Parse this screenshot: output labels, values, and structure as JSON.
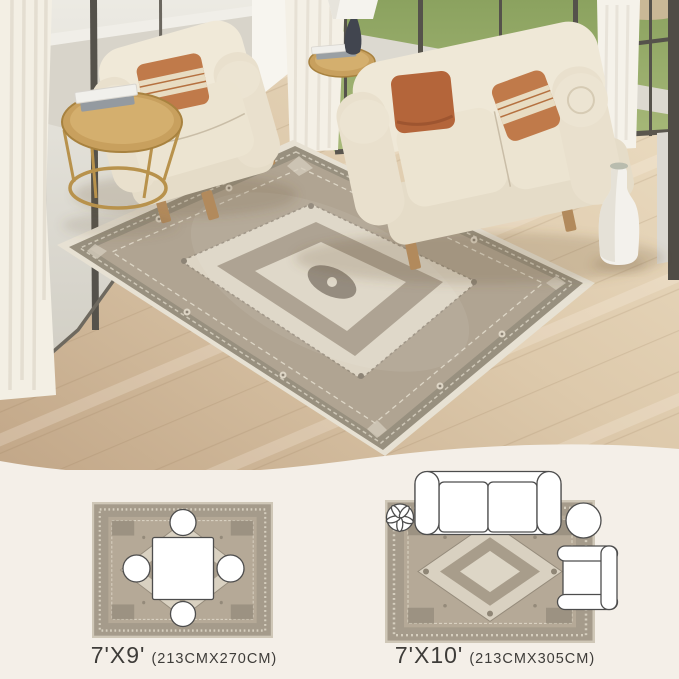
{
  "page": {
    "kind": "rug-product-image",
    "background": "#f4efe8",
    "text_color": "#3e3c39"
  },
  "scene": {
    "name": "living-room-with-medallion-rug",
    "elements": [
      "area-rug",
      "loveseat-sofa",
      "armchair",
      "rust-pillows",
      "gold-side-tables",
      "table-lamp",
      "white-vase",
      "floor-to-ceiling-windows",
      "sheer-curtains",
      "wood-floor"
    ],
    "palette": {
      "rug_field": "#b0a492",
      "rug_border": "#98907f",
      "rug_cream": "#e7e1d3",
      "sofa_cream": "#ece4d2",
      "pillow_rust_solid": "#b4653a",
      "pillow_rust_striped": "#c07a4a",
      "floor_wood": "#d9c3a3",
      "grass_green": "#96ab66",
      "gold_metal": "#c8a05e",
      "window_frame": "#55524b",
      "bottom_panel": "#f4efe8"
    }
  },
  "size_options": [
    {
      "size_label": "7'X9'",
      "dimensions_label": "(213CMX270CM)",
      "layout_icons": [
        "dining-table-icon",
        "dining-chair-icon"
      ]
    },
    {
      "size_label": "7'X10'",
      "dimensions_label": "(213CMX305CM)",
      "layout_icons": [
        "sofa-icon",
        "plant-icon",
        "round-table-icon",
        "armchair-icon"
      ]
    }
  ]
}
